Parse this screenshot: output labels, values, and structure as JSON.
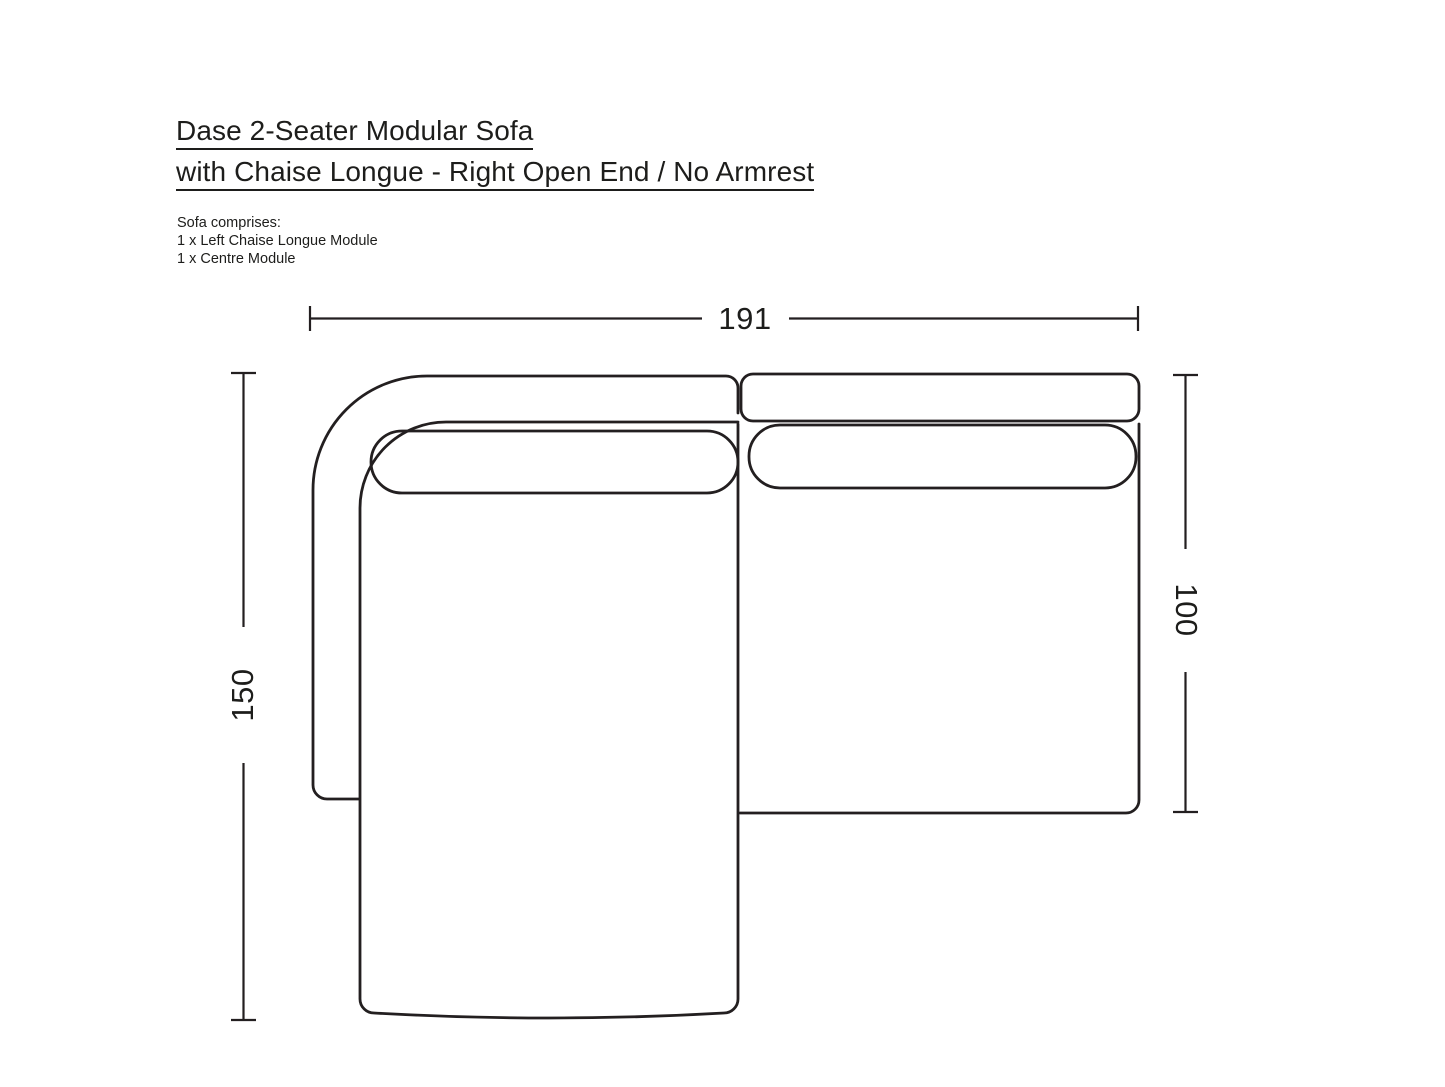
{
  "title": {
    "line1": "Dase 2-Seater Modular Sofa",
    "line2": "with Chaise Longue - Right Open End / No Armrest"
  },
  "sofa_comprises": {
    "heading": "Sofa comprises:",
    "items": [
      "1 x Left Chaise Longue Module",
      "1 x Centre Module"
    ]
  },
  "dimensions": {
    "overall_width": "191",
    "overall_depth": "150",
    "module_depth": "100"
  },
  "colors": {
    "line": "#231f20",
    "background": "#ffffff"
  }
}
